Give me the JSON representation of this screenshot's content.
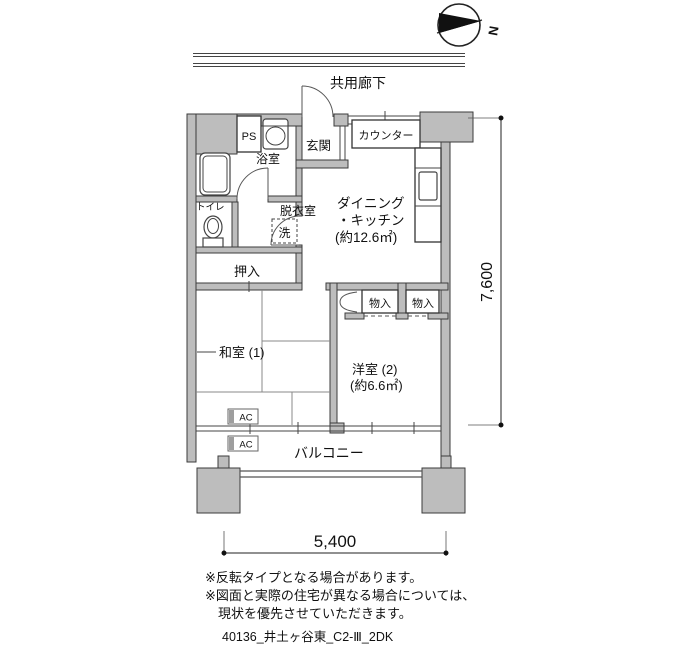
{
  "compass": {
    "north_label": "N"
  },
  "corridor": {
    "label": "共用廊下"
  },
  "rooms": {
    "ps": "PS",
    "bathroom": "浴室",
    "entrance": "玄関",
    "counter": "カウンター",
    "dk_line1": "ダイニング",
    "dk_line2": "・キッチン",
    "dk_line3": "(約12.6㎡)",
    "toilet": "トイレ",
    "dressing_room": "脱衣室",
    "washer": "洗",
    "closet_oshiire": "押入",
    "storage1": "物入",
    "storage2": "物入",
    "japanese_room": "和室 (1)",
    "western_room_line1": "洋室 (2)",
    "western_room_line2": "(約6.6㎡)",
    "balcony": "バルコニー",
    "ac_upper": "AC",
    "ac_lower": "AC"
  },
  "dimensions": {
    "bottom_width": "5,400",
    "right_height": "7,600"
  },
  "notes": [
    "※反転タイプとなる場合があります。",
    "※図面と実際の住宅が異なる場合については、",
    "現状を優先させていただきます。"
  ],
  "footer": "40136_井土ヶ谷東_C2-Ⅲ_2DK"
}
